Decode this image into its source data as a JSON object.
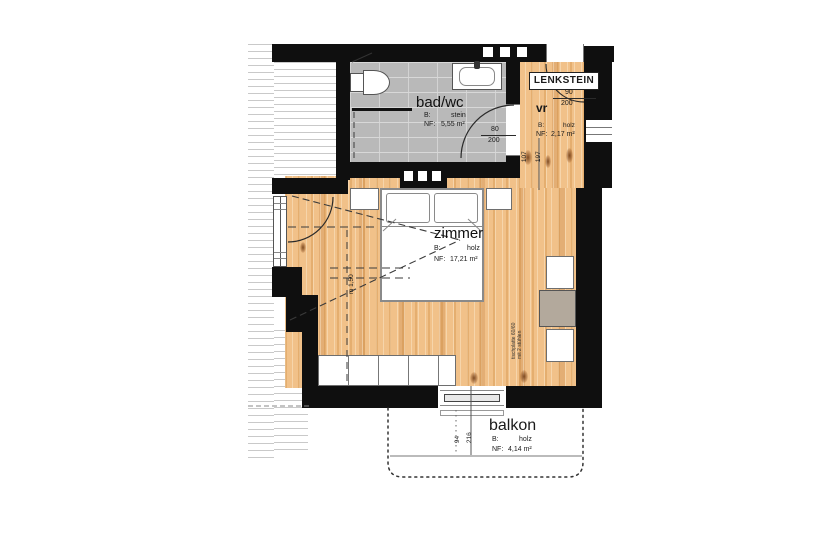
{
  "plan": {
    "title": "LENKSTEIN",
    "rooms": {
      "badwc": {
        "name": "bad/wc",
        "b_label": "B:",
        "b_value": "stein",
        "nf_label": "NF:",
        "nf_value": "5,55 m²"
      },
      "vr": {
        "name": "vr",
        "b_label": "B:",
        "b_value": "holz",
        "nf_label": "NF:",
        "nf_value": "2,17 m²"
      },
      "zimmer": {
        "name": "zimmer",
        "b_label": "B:",
        "b_value": "holz",
        "nf_label": "NF:",
        "nf_value": "17,21 m²"
      },
      "balkon": {
        "name": "balkon",
        "b_label": "B:",
        "b_value": "holz",
        "nf_label": "NF:",
        "nf_value": "4,14 m²"
      }
    },
    "dimensions": {
      "bath_door_w": "80",
      "bath_door_h": "200",
      "entry_door_w": "90",
      "entry_door_h": "200",
      "vr_dim_a": "107",
      "vr_dim_b": "197",
      "balcony_dim_a": "94",
      "balcony_dim_b": "216",
      "height_line": "m 1,50"
    },
    "annotations": {
      "table_note_line1": "tischplatte 60/60",
      "table_note_line2": "mit 2 stühlen"
    },
    "colors": {
      "wall": "#0f0f0f",
      "wood_floor": "#f1c189",
      "stone_floor": "#b9b9b9",
      "table_top": "#b3a99c"
    }
  }
}
